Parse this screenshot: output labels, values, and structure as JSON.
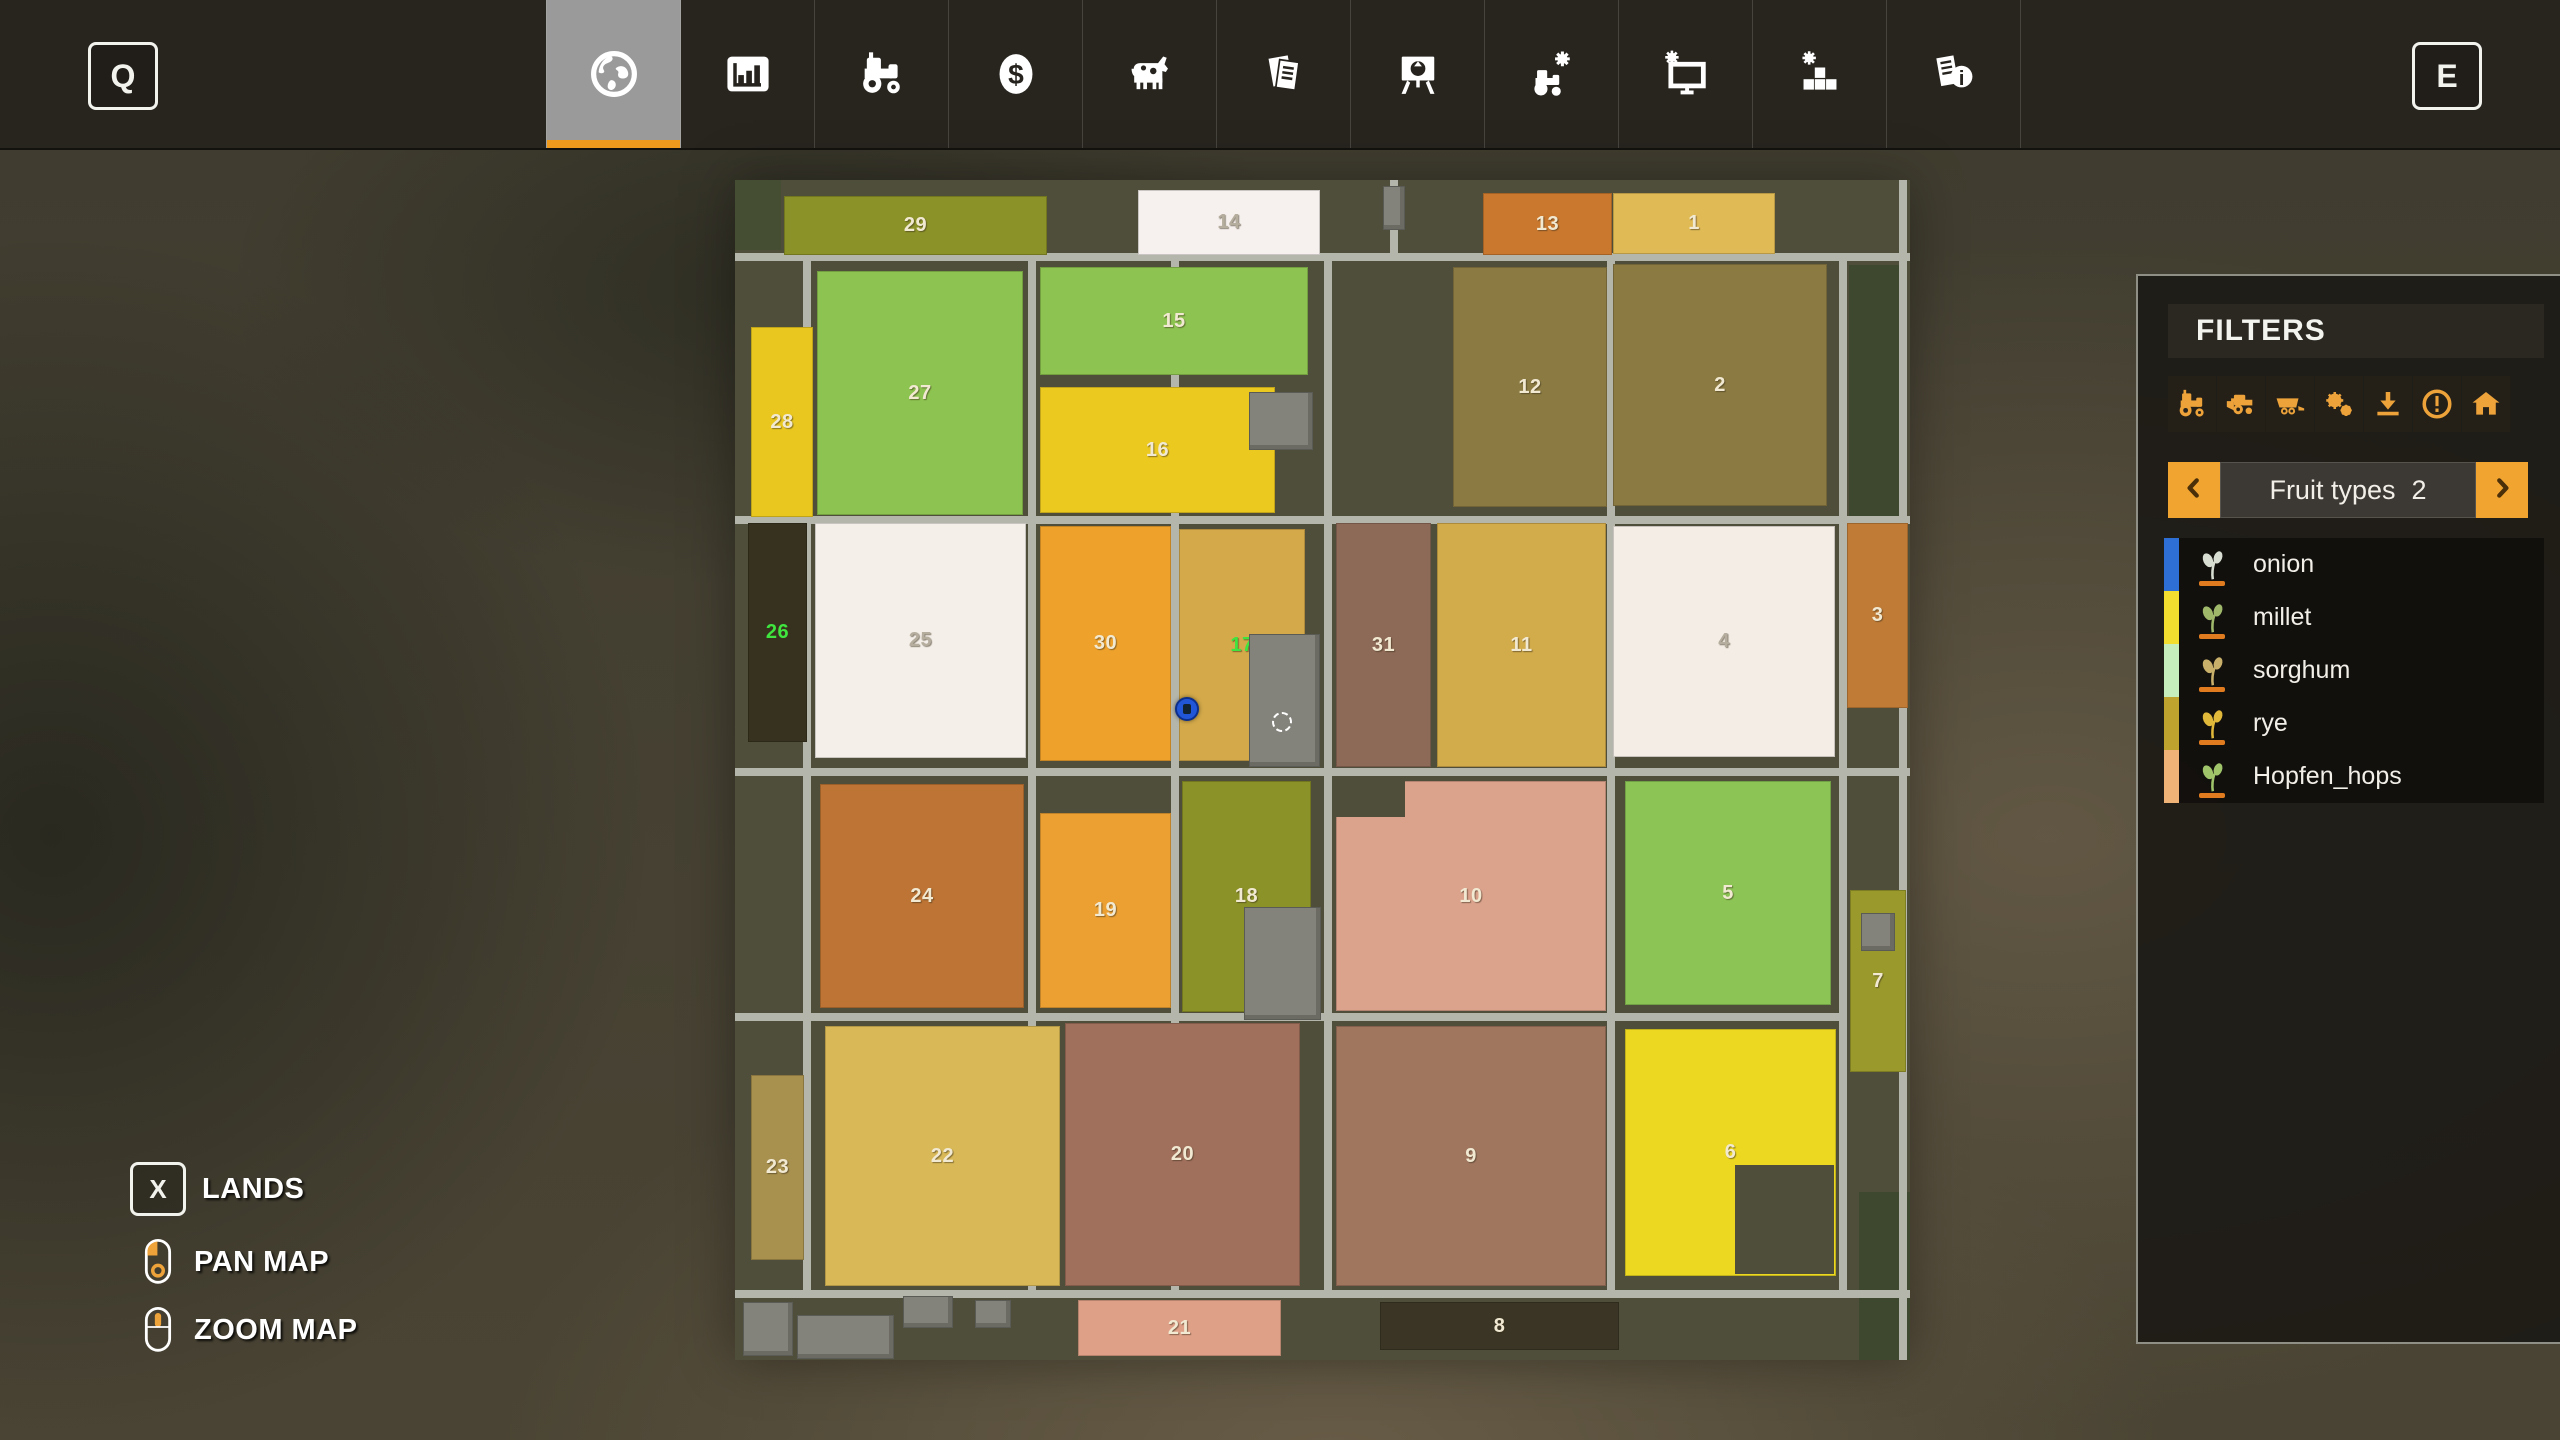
{
  "topbar": {
    "left_key": "Q",
    "right_key": "E",
    "tabs": [
      {
        "name": "map",
        "icon": "globe",
        "selected": true
      },
      {
        "name": "statistics",
        "icon": "chart",
        "selected": false
      },
      {
        "name": "vehicles",
        "icon": "tractor",
        "selected": false
      },
      {
        "name": "finances",
        "icon": "dollar",
        "selected": false
      },
      {
        "name": "animals",
        "icon": "cow",
        "selected": false
      },
      {
        "name": "contracts",
        "icon": "papers",
        "selected": false
      },
      {
        "name": "prices",
        "icon": "easel",
        "selected": false
      },
      {
        "name": "ai-workers",
        "icon": "tractor-gear",
        "selected": false
      },
      {
        "name": "game-settings",
        "icon": "monitor-gear",
        "selected": false
      },
      {
        "name": "general-settings",
        "icon": "blocks-gear",
        "selected": false
      },
      {
        "name": "help",
        "icon": "paper-info",
        "selected": false
      }
    ],
    "accent_color": "#ef9a1c"
  },
  "filters_panel": {
    "title": "FILTERS",
    "icon_color": "#eda23a",
    "filter_icons": [
      "tractor",
      "harvester",
      "trailer",
      "gears",
      "download",
      "warning",
      "house"
    ],
    "selector": {
      "label": "Fruit types",
      "count": "2"
    },
    "fruit_types": [
      {
        "name": "onion",
        "stripe": "#2d6fd4",
        "icon_color": "#d8dfd2"
      },
      {
        "name": "millet",
        "stripe": "#f2de2e",
        "icon_color": "#9fb86a"
      },
      {
        "name": "sorghum",
        "stripe": "#c6eebc",
        "icon_color": "#c9b06a"
      },
      {
        "name": "rye",
        "stripe": "#bea42e",
        "icon_color": "#e0b83a"
      },
      {
        "name": "Hopfen_hops",
        "stripe": "#f0b377",
        "icon_color": "#9fc46a"
      }
    ]
  },
  "legend": {
    "lands_key": "X",
    "lands_label": "LANDS",
    "pan_label": "PAN MAP",
    "zoom_label": "ZOOM MAP"
  },
  "map": {
    "background": "#4f4e3a",
    "road_color": "#b4b6ac",
    "default_label_color": "#f2e9d2",
    "owned_label_color": "#3fe43f",
    "fields": [
      {
        "n": "29",
        "x": 49,
        "y": 16,
        "w": 261,
        "h": 57,
        "c": "#8b9227"
      },
      {
        "n": "14",
        "x": 403,
        "y": 10,
        "w": 180,
        "h": 63,
        "c": "#f6f1ee",
        "lc": "#b5ad9e"
      },
      {
        "n": "13",
        "x": 748,
        "y": 13,
        "w": 127,
        "h": 60,
        "c": "#c9782e"
      },
      {
        "n": "1",
        "x": 878,
        "y": 13,
        "w": 160,
        "h": 59,
        "c": "#e0ba55"
      },
      {
        "n": "27",
        "x": 82,
        "y": 91,
        "w": 204,
        "h": 242,
        "c": "#8dc350"
      },
      {
        "n": "15",
        "x": 305,
        "y": 87,
        "w": 266,
        "h": 106,
        "c": "#8dc350"
      },
      {
        "n": "16",
        "x": 305,
        "y": 207,
        "w": 233,
        "h": 124,
        "c": "#ecc91f"
      },
      {
        "n": "28",
        "x": 16,
        "y": 147,
        "w": 60,
        "h": 188,
        "c": "#e9c71f"
      },
      {
        "n": "12",
        "x": 718,
        "y": 87,
        "w": 152,
        "h": 238,
        "c": "#8b7b42"
      },
      {
        "n": "2",
        "x": 878,
        "y": 84,
        "w": 212,
        "h": 240,
        "c": "#8b7b42"
      },
      {
        "n": "26",
        "x": 13,
        "y": 343,
        "w": 57,
        "h": 217,
        "c": "#37321f",
        "lc": "#3fe43f"
      },
      {
        "n": "25",
        "x": 80,
        "y": 343,
        "w": 209,
        "h": 233,
        "c": "#f4efe9",
        "lc": "#b5ad9e"
      },
      {
        "n": "30",
        "x": 305,
        "y": 346,
        "w": 129,
        "h": 233,
        "c": "#efa22b"
      },
      {
        "n": "17",
        "x": 444,
        "y": 349,
        "w": 124,
        "h": 230,
        "c": "#d3a94a",
        "lc": "#3fe43f"
      },
      {
        "n": "31",
        "x": 601,
        "y": 343,
        "w": 93,
        "h": 242,
        "c": "#8d6a57"
      },
      {
        "n": "11",
        "x": 702,
        "y": 343,
        "w": 167,
        "h": 242,
        "c": "#d2ab4a"
      },
      {
        "n": "4",
        "x": 878,
        "y": 346,
        "w": 220,
        "h": 229,
        "c": "#f3ede5",
        "lc": "#b5ad9e"
      },
      {
        "n": "3",
        "x": 1112,
        "y": 343,
        "w": 59,
        "h": 183,
        "c": "#c07b36"
      },
      {
        "n": "24",
        "x": 85,
        "y": 604,
        "w": 202,
        "h": 222,
        "c": "#bd7434"
      },
      {
        "n": "19",
        "x": 305,
        "y": 633,
        "w": 129,
        "h": 193,
        "c": "#eca032"
      },
      {
        "n": "18",
        "x": 447,
        "y": 601,
        "w": 127,
        "h": 229,
        "c": "#8b9227"
      },
      {
        "n": "10",
        "x": 601,
        "y": 601,
        "w": 268,
        "h": 228,
        "c": "#dba28c"
      },
      {
        "n": "5",
        "x": 890,
        "y": 601,
        "w": 204,
        "h": 222,
        "c": "#8cc455"
      },
      {
        "n": "7",
        "x": 1115,
        "y": 710,
        "w": 54,
        "h": 180,
        "c": "#99992c"
      },
      {
        "n": "23",
        "x": 16,
        "y": 895,
        "w": 51,
        "h": 183,
        "c": "#a8904e"
      },
      {
        "n": "22",
        "x": 90,
        "y": 846,
        "w": 233,
        "h": 258,
        "c": "#d9b957"
      },
      {
        "n": "20",
        "x": 330,
        "y": 843,
        "w": 233,
        "h": 261,
        "c": "#a0705c"
      },
      {
        "n": "9",
        "x": 601,
        "y": 846,
        "w": 268,
        "h": 258,
        "c": "#a0765f"
      },
      {
        "n": "6",
        "x": 890,
        "y": 849,
        "w": 209,
        "h": 245,
        "c": "#ecd820"
      },
      {
        "n": "8",
        "x": 645,
        "y": 1122,
        "w": 237,
        "h": 46,
        "c": "#3a3524"
      },
      {
        "n": "21",
        "x": 343,
        "y": 1120,
        "w": 201,
        "h": 54,
        "c": "#dfa088"
      }
    ],
    "notches": [
      {
        "x": 601,
        "y": 601,
        "w": 69,
        "h": 36
      },
      {
        "x": 1000,
        "y": 985,
        "w": 99,
        "h": 109
      }
    ],
    "roads": {
      "thickness": 8,
      "h": [
        {
          "x": 0,
          "y": 73,
          "w": 1175
        },
        {
          "x": 0,
          "y": 336,
          "w": 1175
        },
        {
          "x": 0,
          "y": 588,
          "w": 1175
        },
        {
          "x": 0,
          "y": 833,
          "w": 1104
        },
        {
          "x": 0,
          "y": 1110,
          "w": 1175
        }
      ],
      "v": [
        {
          "x": 68,
          "y": 73,
          "h": 1045
        },
        {
          "x": 293,
          "y": 73,
          "h": 1045
        },
        {
          "x": 436,
          "y": 73,
          "h": 1045
        },
        {
          "x": 589,
          "y": 73,
          "h": 1045
        },
        {
          "x": 872,
          "y": 73,
          "h": 1045
        },
        {
          "x": 1104,
          "y": 73,
          "h": 1045
        },
        {
          "x": 1164,
          "y": 0,
          "h": 1180
        },
        {
          "x": 655,
          "y": 0,
          "h": 77
        }
      ]
    },
    "tree_patches": [
      {
        "x": 1114,
        "y": 85,
        "w": 55,
        "h": 260,
        "c": "#3d482e"
      },
      {
        "x": 1124,
        "y": 1012,
        "w": 51,
        "h": 168,
        "c": "#3d482e"
      },
      {
        "x": 0,
        "y": 0,
        "w": 46,
        "h": 70,
        "c": "#454e33"
      }
    ],
    "buildings": [
      {
        "x": 514,
        "y": 212,
        "w": 62,
        "h": 56
      },
      {
        "x": 514,
        "y": 454,
        "w": 69,
        "h": 131
      },
      {
        "x": 509,
        "y": 727,
        "w": 75,
        "h": 111
      },
      {
        "x": 8,
        "y": 1122,
        "w": 48,
        "h": 52
      },
      {
        "x": 62,
        "y": 1135,
        "w": 95,
        "h": 42
      },
      {
        "x": 168,
        "y": 1116,
        "w": 48,
        "h": 30
      },
      {
        "x": 240,
        "y": 1120,
        "w": 34,
        "h": 26
      },
      {
        "x": 1126,
        "y": 733,
        "w": 32,
        "h": 36
      },
      {
        "x": 648,
        "y": 6,
        "w": 20,
        "h": 42
      }
    ],
    "markers": {
      "player": {
        "x": 450,
        "y": 527,
        "color": "#2256d8"
      },
      "selection_circle": {
        "x": 545,
        "y": 540
      }
    }
  }
}
